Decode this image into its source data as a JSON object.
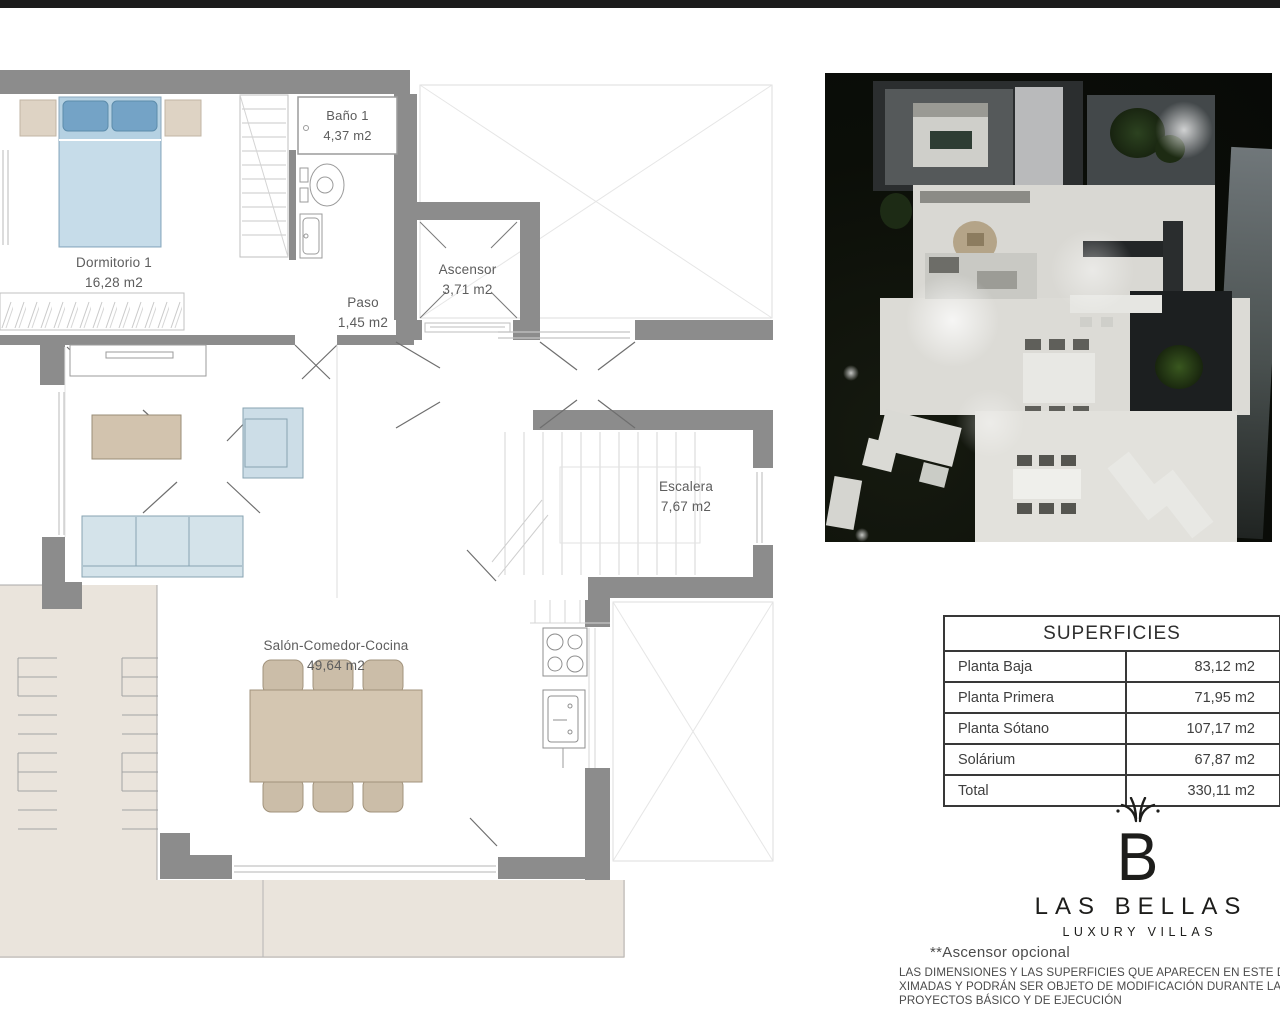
{
  "palette": {
    "wall_gray": "#8c8c8c",
    "terrace_beige": "#eae4dc",
    "bed_blue": "#b5d1e2",
    "pillow_blue": "#74a3c6",
    "sofa_blue": "#d4e3ea",
    "furniture_tan": "#d4c6b1",
    "logo_black": "#1d1d1b"
  },
  "floor_plan": {
    "rooms": [
      {
        "name": "Dormitorio 1",
        "area": "16,28 m2"
      },
      {
        "name": "Baño 1",
        "area": "4,37 m2"
      },
      {
        "name": "Paso",
        "area": "1,45 m2"
      },
      {
        "name": "Ascensor",
        "area": "3,71 m2"
      },
      {
        "name": "Escalera",
        "area": "7,67 m2"
      },
      {
        "name": "Salón-Comedor-Cocina",
        "area": "49,64 m2"
      }
    ]
  },
  "superficies_table": {
    "title": "SUPERFICIES",
    "rows": [
      {
        "label": "Planta Baja",
        "value": "83,12 m2"
      },
      {
        "label": "Planta Primera",
        "value": "71,95 m2"
      },
      {
        "label": "Planta Sótano",
        "value": "107,17 m2"
      },
      {
        "label": "Solárium",
        "value": "67,87 m2"
      },
      {
        "label": "Total",
        "value": "330,11 m2"
      }
    ]
  },
  "brand": {
    "monogram": "B",
    "name": "LAS BELLAS",
    "tagline": "LUXURY VILLAS"
  },
  "footnotes": {
    "elevator_note": "**Ascensor opcional",
    "disclaimer_lines": [
      "LAS DIMENSIONES Y LAS SUPERFICIES QUE APARECEN EN ESTE DOCUMENT",
      "XIMADAS Y PODRÁN SER OBJETO DE MODIFICACIÓN DURANTE LA REDAC",
      "PROYECTOS BÁSICO Y DE EJECUCIÓN"
    ]
  }
}
